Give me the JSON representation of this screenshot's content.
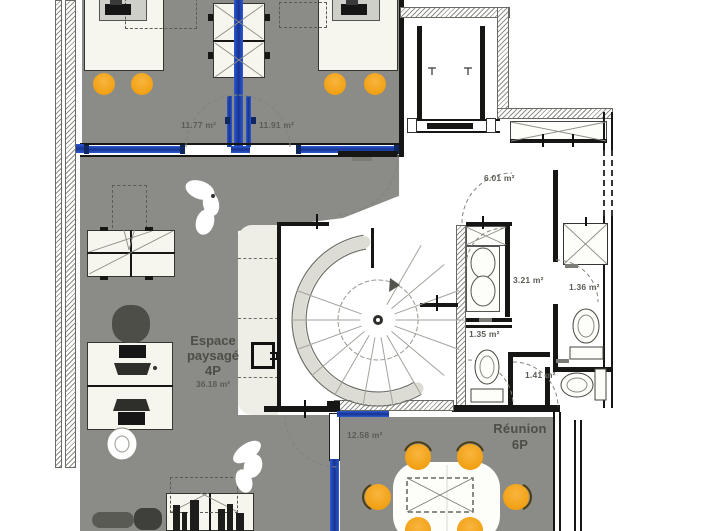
{
  "plan": {
    "labels": {
      "office_left_area": "11.77 m²",
      "office_right_area": "11.91 m²",
      "hall_area": "6.01 m²",
      "sanitary_area": "3.21 m²",
      "wc_top_area": "1.36 m²",
      "wc_left_area": "1.35 m²",
      "wc_right_area": "1.41 m²",
      "corridor_area": "12.58 m²",
      "open_space_name_line1": "Espace",
      "open_space_name_line2": "paysagé",
      "open_space_capacity": "4P",
      "open_space_area": "36.18 m²",
      "meeting_name": "Réunion",
      "meeting_capacity": "6P"
    },
    "colors": {
      "floor_gray": "#8b8b87",
      "glass_blue": "#2350c8",
      "chair_yellow": "#f6a71f",
      "wall_black": "#161614",
      "label_gray": "#5c5c55",
      "surface_cream": "#efeee6"
    }
  }
}
